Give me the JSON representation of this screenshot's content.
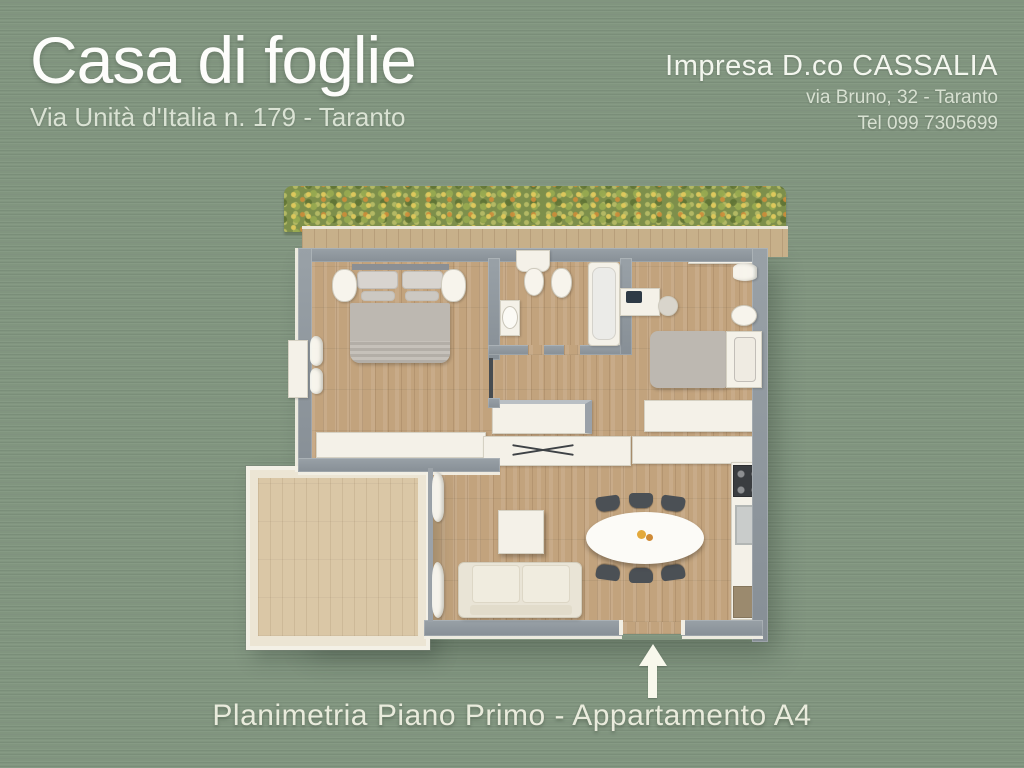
{
  "header": {
    "title": "Casa di foglie",
    "subtitle": "Via Unità d'Italia n. 179 - Taranto",
    "company": {
      "name": "Impresa D.co CASSALIA",
      "address": "via Bruno, 32 - Taranto",
      "phone": "Tel 099 7305699"
    }
  },
  "footer": {
    "caption": "Planimetria Piano Primo - Appartamento A4"
  },
  "plan": {
    "icons": {
      "entrance_arrow": "arrow-up-icon"
    },
    "palette": {
      "background": "#81957F",
      "wall_gray": "#8D959C",
      "wood_floor": "#C2A37D",
      "balcony_deck": "#DAC7A6",
      "fixture_white": "#F4F1E8",
      "hedge_green": "#7D8F4B",
      "linen_gray": "#BDB8B1",
      "chair_dark": "#4B5055",
      "text_light": "#E9EBDC"
    }
  }
}
